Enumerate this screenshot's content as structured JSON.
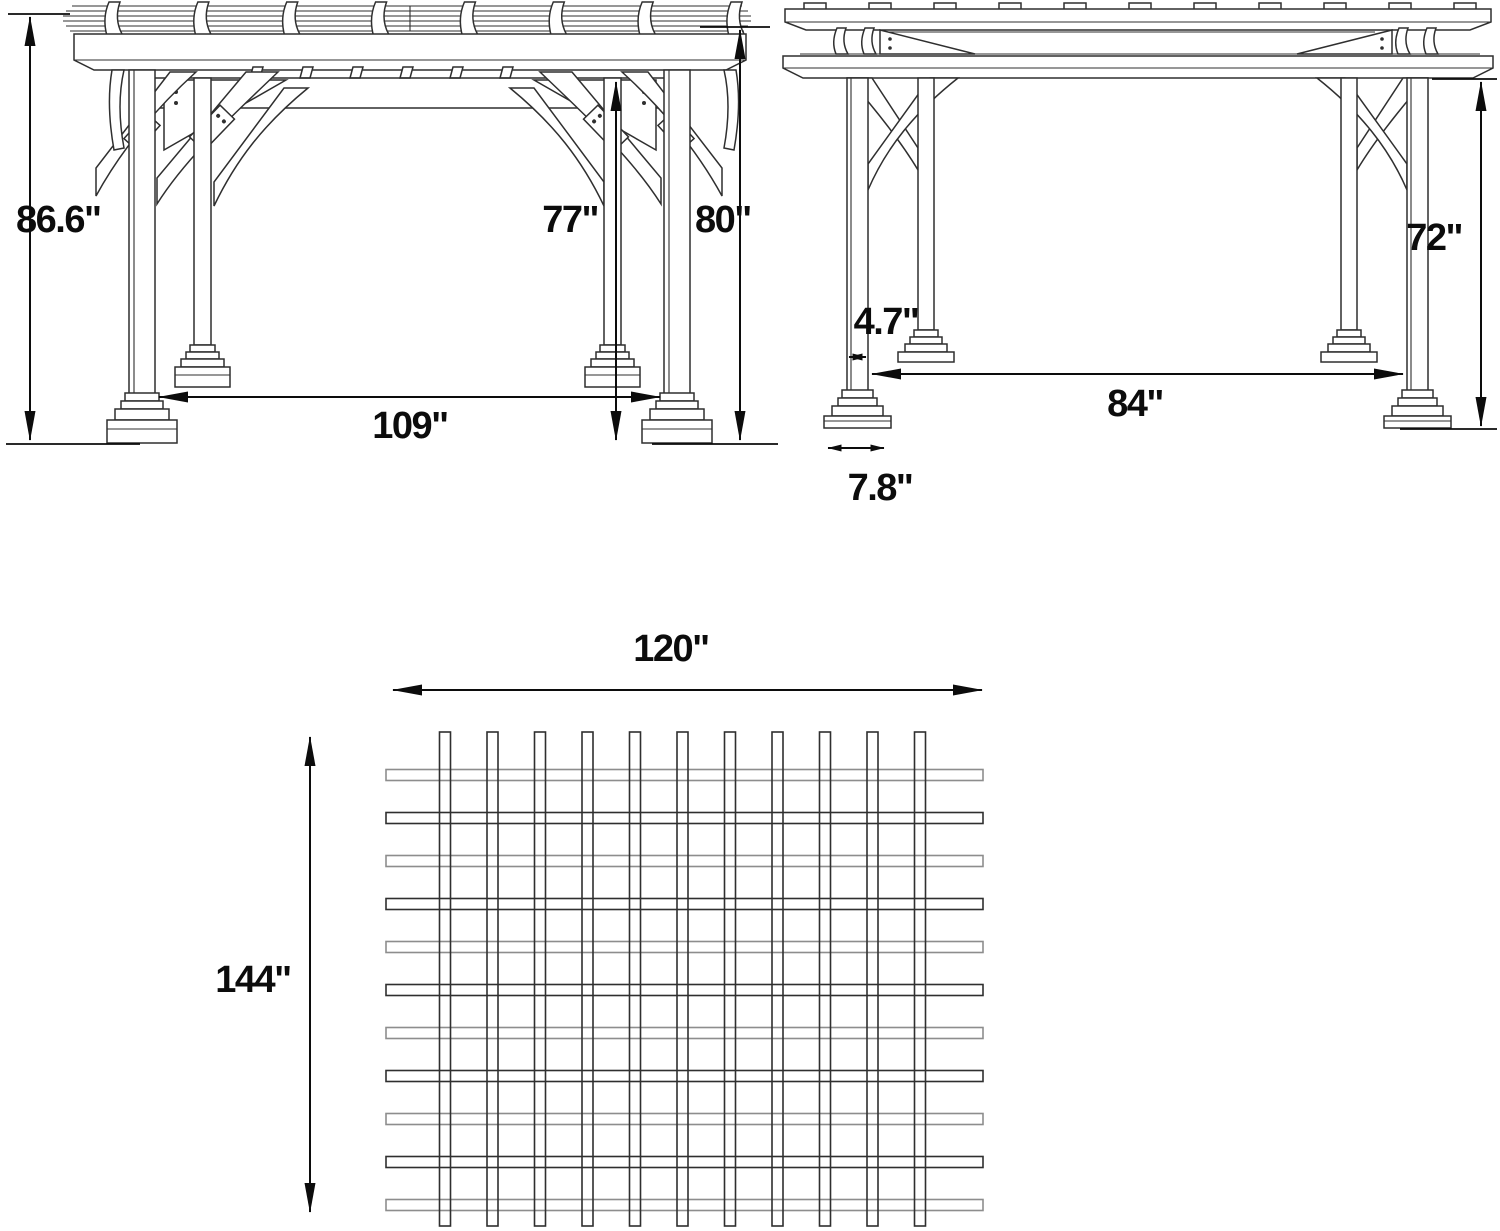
{
  "drawing": {
    "title": "Pergola three-view dimension drawing",
    "line_color": "#2f2f2f",
    "line_light_color": "#8d8d8d",
    "dim_color": "#0c0c0c",
    "background": "#ffffff"
  },
  "views": {
    "front": {
      "name": "front-elevation",
      "rafter_tail_count": 8,
      "purlin_tab_count": 6,
      "dimensions": [
        {
          "id": "overall-height",
          "label": "86.6\""
        },
        {
          "id": "clearance-height",
          "label": "77\""
        },
        {
          "id": "frame-height",
          "label": "80\""
        },
        {
          "id": "post-spacing",
          "label": "109\""
        }
      ]
    },
    "side": {
      "name": "side-elevation",
      "roof_tab_count": 11,
      "dimensions": [
        {
          "id": "post-height",
          "label": "72\""
        },
        {
          "id": "post-width",
          "label": "4.7\""
        },
        {
          "id": "post-spacing",
          "label": "84\""
        },
        {
          "id": "base-width",
          "label": "7.8\""
        }
      ]
    },
    "plan": {
      "name": "roof-plan",
      "grid": {
        "vertical_slats": 11,
        "horizontal_slats": 11
      },
      "dimensions": [
        {
          "id": "roof-width",
          "label": "120\""
        },
        {
          "id": "roof-depth",
          "label": "144\""
        }
      ]
    }
  }
}
